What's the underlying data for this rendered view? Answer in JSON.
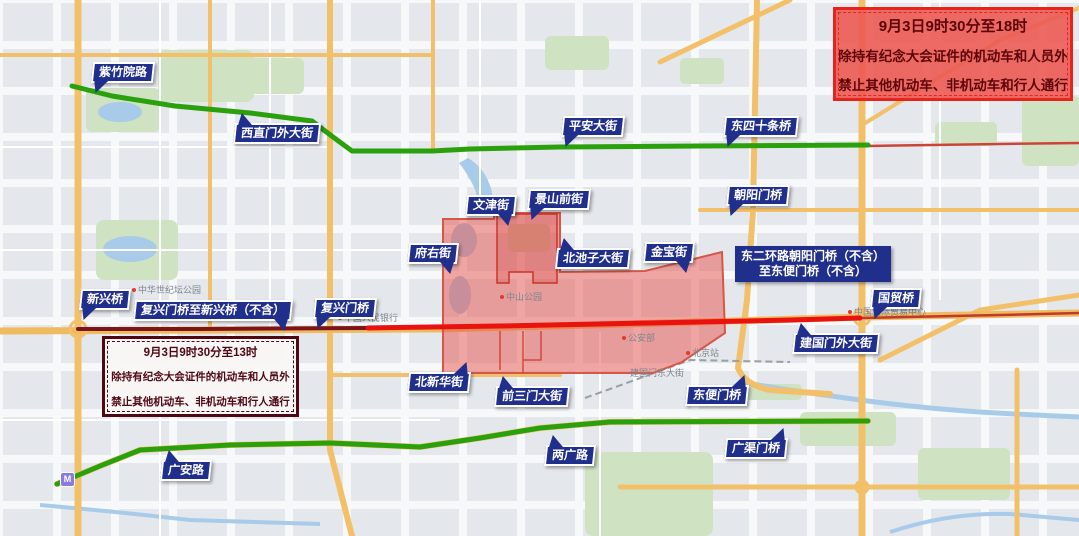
{
  "notices": {
    "right": {
      "line1": "9月3日9时30分至18时",
      "line2": "除持有纪念大会证件的机动车和人员外",
      "line3": "禁止其他机动车、非机动车和行人通行"
    },
    "left": {
      "line1": "9月3日9时30分至13时",
      "line2": "除持有纪念大会证件的机动车和人员外",
      "line3": "禁止其他机动车、非机动车和行人通行"
    }
  },
  "banners": [
    {
      "label": "紫竹院路"
    },
    {
      "label": "西直门外大街"
    },
    {
      "label": "平安大街"
    },
    {
      "label": "东四十条桥"
    },
    {
      "label": "文津街"
    },
    {
      "label": "景山前街"
    },
    {
      "label": "朝阳门桥"
    },
    {
      "label": "府右街"
    },
    {
      "label": "北池子大街"
    },
    {
      "label": "金宝街"
    },
    {
      "label": "新兴桥"
    },
    {
      "label": "复兴门桥至新兴桥（不含）"
    },
    {
      "label": "复兴门桥"
    },
    {
      "label": "国贸桥"
    },
    {
      "label": "建国门外大街"
    },
    {
      "label": "北新华街"
    },
    {
      "label": "前三门大街"
    },
    {
      "label": "东便门桥"
    },
    {
      "label": "两广路"
    },
    {
      "label": "广渠门桥"
    },
    {
      "label": "广安路"
    }
  ],
  "ring_note": {
    "line1": "东二环路朝阳门桥（不含）",
    "line2": "至东便门桥（不含）"
  },
  "map_labels": [
    {
      "text": "中华世纪坛公园"
    },
    {
      "text": "中国人民银行"
    },
    {
      "text": "中山公园"
    },
    {
      "text": "公安部"
    },
    {
      "text": "北京站"
    },
    {
      "text": "建国门东大街"
    },
    {
      "text": "中国国际贸易中心"
    }
  ],
  "metro_icon_label": "M",
  "colors": {
    "route_green": "#2aa10c",
    "route_bright_red": "#ea120e",
    "route_dark_red": "#7c151a",
    "zone_fill": "rgba(232,82,75,0.5)",
    "zone_stroke": "#d4574a",
    "banner_blue": "#202e8c"
  }
}
